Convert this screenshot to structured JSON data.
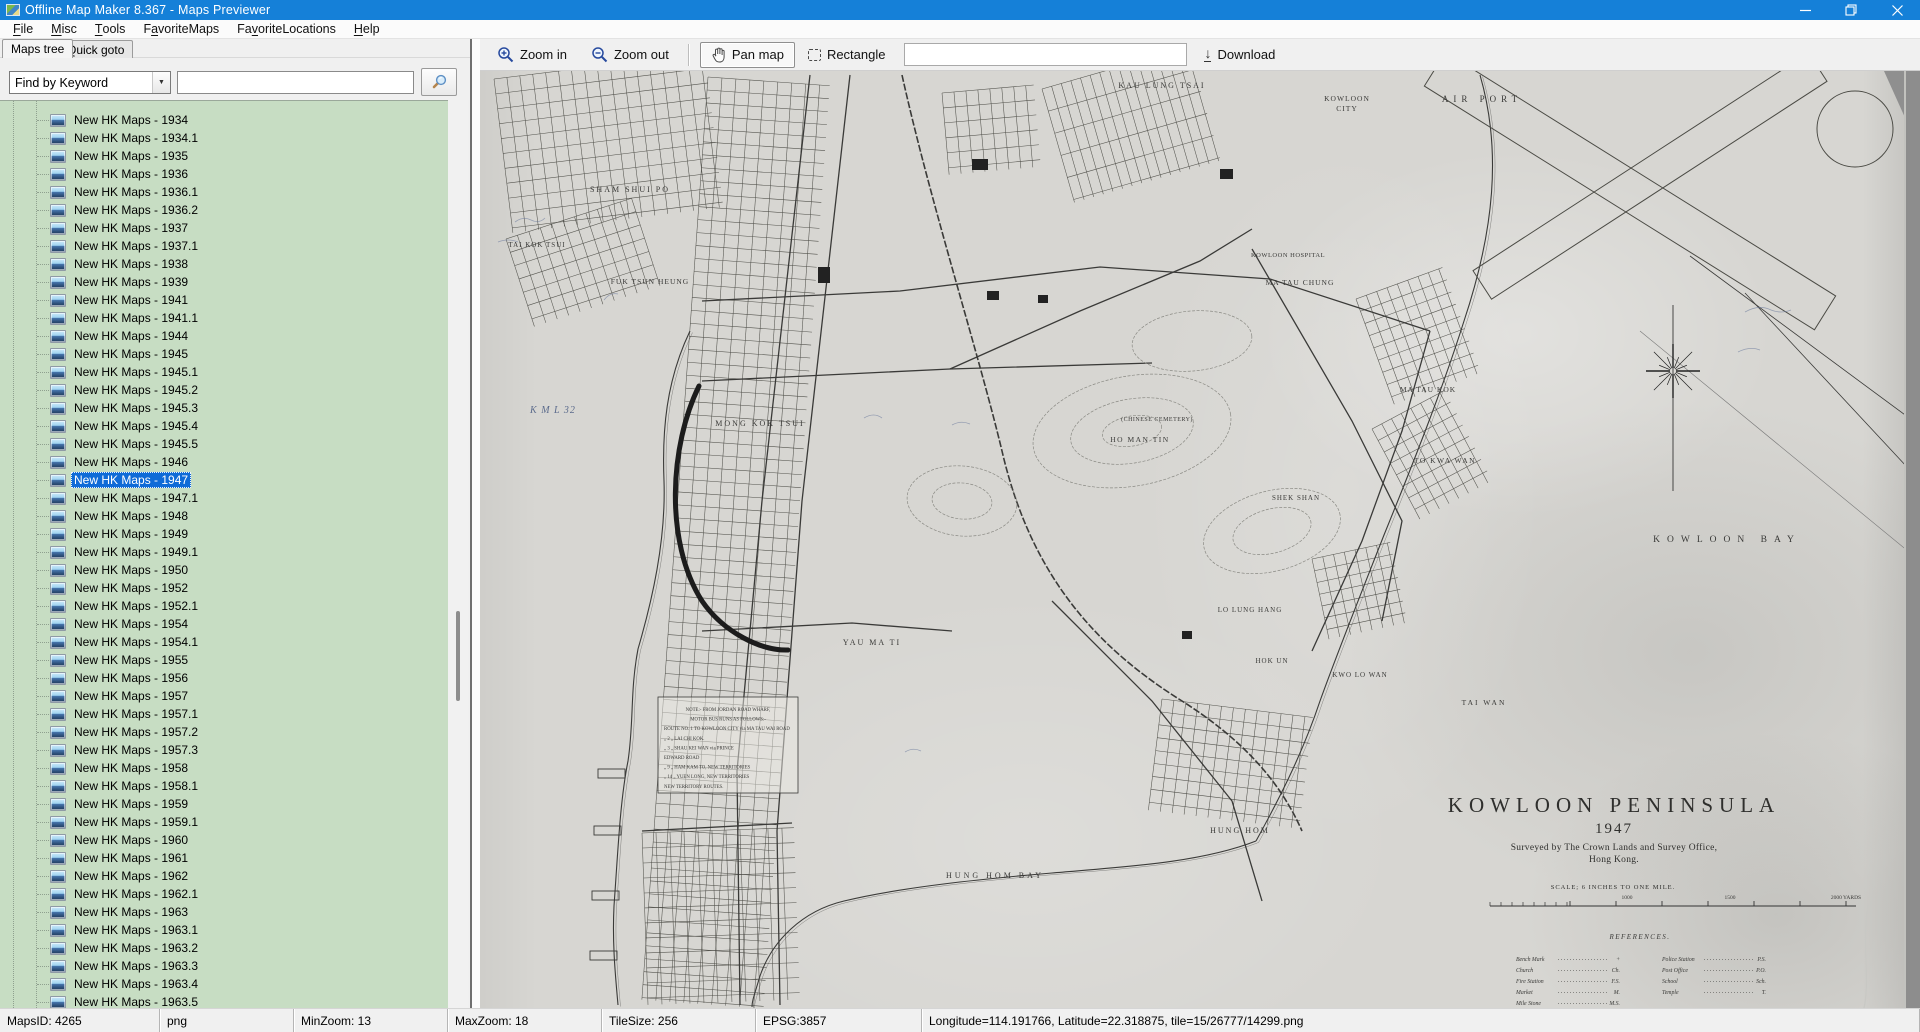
{
  "window": {
    "title": "Offline Map Maker 8.367 - Maps Previewer"
  },
  "menu": {
    "items": [
      {
        "label": "File",
        "underline": 0
      },
      {
        "label": "Misc",
        "underline": 0
      },
      {
        "label": "Tools",
        "underline": 0
      },
      {
        "label": "FavoriteMaps",
        "underline": 1
      },
      {
        "label": "FavoriteLocations",
        "underline": 2
      },
      {
        "label": "Help",
        "underline": 0
      }
    ]
  },
  "sidebar": {
    "tabs": [
      {
        "label": "Maps tree",
        "active": true
      },
      {
        "label": "Quick goto",
        "active": false
      }
    ],
    "search": {
      "mode_value": "Find by Keyword",
      "query_value": ""
    },
    "tree": {
      "selected_index": 20,
      "items": [
        "New HK Maps - 1934",
        "New HK Maps - 1934.1",
        "New HK Maps - 1935",
        "New HK Maps - 1936",
        "New HK Maps - 1936.1",
        "New HK Maps - 1936.2",
        "New HK Maps - 1937",
        "New HK Maps - 1937.1",
        "New HK Maps - 1938",
        "New HK Maps - 1939",
        "New HK Maps - 1941",
        "New HK Maps - 1941.1",
        "New HK Maps - 1944",
        "New HK Maps - 1945",
        "New HK Maps - 1945.1",
        "New HK Maps - 1945.2",
        "New HK Maps - 1945.3",
        "New HK Maps - 1945.4",
        "New HK Maps - 1945.5",
        "New HK Maps - 1946",
        "New HK Maps - 1947",
        "New HK Maps - 1947.1",
        "New HK Maps - 1948",
        "New HK Maps - 1949",
        "New HK Maps - 1949.1",
        "New HK Maps - 1950",
        "New HK Maps - 1952",
        "New HK Maps - 1952.1",
        "New HK Maps - 1954",
        "New HK Maps - 1954.1",
        "New HK Maps - 1955",
        "New HK Maps - 1956",
        "New HK Maps - 1957",
        "New HK Maps - 1957.1",
        "New HK Maps - 1957.2",
        "New HK Maps - 1957.3",
        "New HK Maps - 1958",
        "New HK Maps - 1958.1",
        "New HK Maps - 1959",
        "New HK Maps - 1959.1",
        "New HK Maps - 1960",
        "New HK Maps - 1961",
        "New HK Maps - 1962",
        "New HK Maps - 1962.1",
        "New HK Maps - 1963",
        "New HK Maps - 1963.1",
        "New HK Maps - 1963.2",
        "New HK Maps - 1963.3",
        "New HK Maps - 1963.4",
        "New HK Maps - 1963.5"
      ]
    }
  },
  "toolbar": {
    "zoom_in": "Zoom in",
    "zoom_out": "Zoom out",
    "pan_map": "Pan map",
    "rectangle": "Rectangle",
    "download": "Download",
    "input_value": ""
  },
  "statusbar": {
    "panels": [
      "MapsID: 4265",
      "png",
      "MinZoom: 13",
      "MaxZoom: 18",
      "TileSize: 256",
      "EPSG:3857",
      "Longitude=114.191766, Latitude=22.318875, tile=15/26777/14299.png"
    ]
  },
  "map": {
    "title_block": {
      "title": "KOWLOON PENINSULA",
      "year": "1947",
      "surveyed1": "Surveyed by The Crown Lands and Survey Office,",
      "surveyed2": "Hong Kong.",
      "scale_text": "SCALE; 6 INCHES TO ONE MILE."
    },
    "scale_marks": [
      {
        "t": "1000",
        "x": 1147
      },
      {
        "t": "1500",
        "x": 1250
      },
      {
        "t": "2000 YARDS",
        "x": 1366
      }
    ],
    "labels": [
      {
        "t": "KAU LUNG TSAI",
        "x": 682,
        "y": 17,
        "s": 8,
        "ls": 2
      },
      {
        "t": "KOWLOON",
        "x": 867,
        "y": 30,
        "s": 7.5,
        "ls": 1
      },
      {
        "t": "CITY",
        "x": 867,
        "y": 40,
        "s": 7.5,
        "ls": 1
      },
      {
        "t": "AIR PORT",
        "x": 1002,
        "y": 31,
        "s": 9,
        "ls": 5
      },
      {
        "t": "SHAM SHUI PO",
        "x": 150,
        "y": 121,
        "s": 8,
        "ls": 2
      },
      {
        "t": "TAI KOK TSUI",
        "x": 57,
        "y": 176,
        "s": 7,
        "ls": 1
      },
      {
        "t": "FUK TSUN HEUNG",
        "x": 170,
        "y": 213,
        "s": 7.5,
        "ls": 1
      },
      {
        "t": "KOWLOON HOSPITAL",
        "x": 808,
        "y": 186,
        "s": 6.5,
        "ls": 0.5
      },
      {
        "t": "MA TAU CHUNG",
        "x": 820,
        "y": 214,
        "s": 7.5,
        "ls": 1
      },
      {
        "t": "MA TAU KOK",
        "x": 948,
        "y": 321,
        "s": 7.5,
        "ls": 1
      },
      {
        "t": "MONG KOK TSUI",
        "x": 280,
        "y": 355,
        "s": 8,
        "ls": 2
      },
      {
        "t": "(CHINESE CEMETERY)",
        "x": 677,
        "y": 350,
        "s": 6,
        "ls": 0.5
      },
      {
        "t": "HO MAN TIN",
        "x": 660,
        "y": 371,
        "s": 7.5,
        "ls": 1.5
      },
      {
        "t": "TO KWA WAN",
        "x": 965,
        "y": 392,
        "s": 7.5,
        "ls": 1.5
      },
      {
        "t": "SHEK SHAN",
        "x": 816,
        "y": 429,
        "s": 7,
        "ls": 1
      },
      {
        "t": "KOWLOON   BAY",
        "x": 1247,
        "y": 471,
        "s": 9.5,
        "ls": 7
      },
      {
        "t": "YAU MA TI",
        "x": 392,
        "y": 574,
        "s": 8,
        "ls": 2
      },
      {
        "t": "LO LUNG HANG",
        "x": 770,
        "y": 541,
        "s": 7,
        "ls": 1
      },
      {
        "t": "HOK UN",
        "x": 792,
        "y": 592,
        "s": 7,
        "ls": 1
      },
      {
        "t": "KWO LO WAN",
        "x": 880,
        "y": 606,
        "s": 7,
        "ls": 1
      },
      {
        "t": "TAI WAN",
        "x": 1004,
        "y": 634,
        "s": 7.5,
        "ls": 2
      },
      {
        "t": "HUNG HOM",
        "x": 760,
        "y": 762,
        "s": 8,
        "ls": 2
      },
      {
        "t": "HUNG HOM BAY",
        "x": 515,
        "y": 807,
        "s": 8,
        "ls": 3
      },
      {
        "t": "K M L 32",
        "x": 73,
        "y": 342,
        "s": 10,
        "ls": 1,
        "style": "hand"
      }
    ],
    "references": {
      "heading": "REFERENCES.",
      "left": [
        {
          "label": "Bench Mark",
          "abbr": "+"
        },
        {
          "label": "Church",
          "abbr": "Ch."
        },
        {
          "label": "Fire Station",
          "abbr": "F.S."
        },
        {
          "label": "Market",
          "abbr": "M."
        },
        {
          "label": "Mile Stone",
          "abbr": "M.S."
        }
      ],
      "right": [
        {
          "label": "Police Station",
          "abbr": "P.S."
        },
        {
          "label": "Post Office",
          "abbr": "P.O."
        },
        {
          "label": "School",
          "abbr": "Sch."
        },
        {
          "label": "Temple",
          "abbr": "T."
        }
      ]
    },
    "note_box": {
      "lines": [
        "NOTE:-  FROM  JORDAN  ROAD  WHARF,",
        "MOTOR  BUS  RUNS  AS  FOLLOWS:-",
        "ROUTE NO. 1  TO  KOWLOON CITY via MA TAU WAI ROAD",
        "„   2  „   LAI CHI KOK.",
        "„   3  „   SHAU KEI WAN via PRINCE",
        "EDWARD ROAD",
        "„   9  „   HAM KAM TO, NEW TERRITORIES",
        "„  14  „   YUEN LONG, NEW TERRITORIES",
        "NEW  TERRITORY  ROUTES."
      ]
    }
  }
}
